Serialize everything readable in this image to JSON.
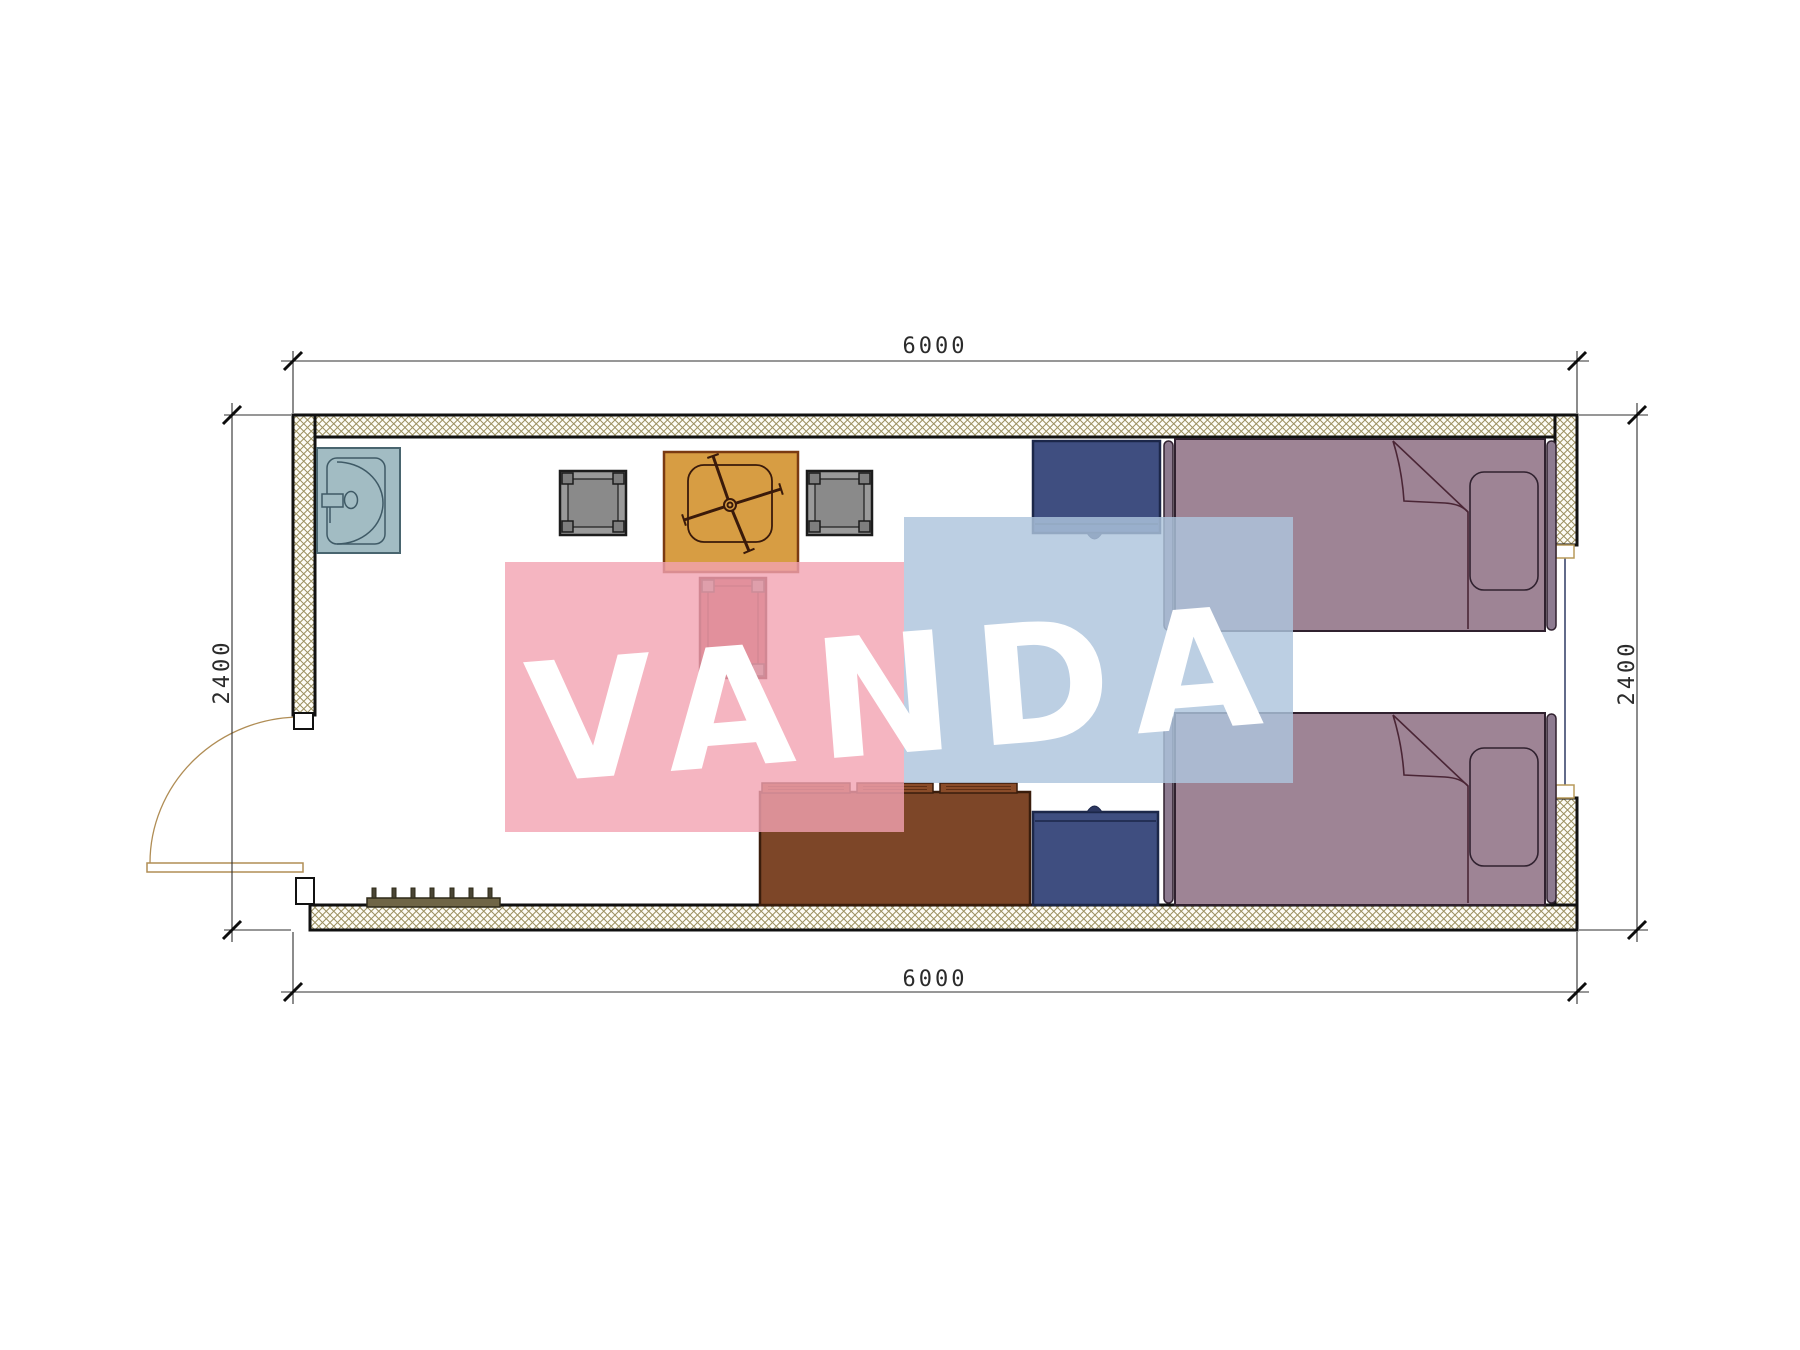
{
  "plan": {
    "type": "floor-plan",
    "room_width_mm": "6000",
    "room_depth_mm": "2400",
    "dimensions": {
      "top": "6000",
      "bottom": "6000",
      "left": "2400",
      "right": "2400"
    },
    "furniture": [
      "sink",
      "desk",
      "task-chair",
      "stool-left",
      "stool-right",
      "side-table",
      "sofa",
      "nightstand-top",
      "nightstand-bottom",
      "bed-top",
      "bed-bottom",
      "shoe-rack",
      "door",
      "window"
    ]
  },
  "watermark": {
    "text": "VANDA"
  },
  "colors": {
    "wall-line": "#111111",
    "hatch-line": "#9c9060",
    "hatch-bg": "#fdfcf6",
    "dim-line": "#2f2f2f",
    "dim-text": "#2b2b2b",
    "sill-line": "#b89a5a",
    "window-glass": "#2e3a63",
    "door-line": "#b08d55",
    "sink-fill": "#a2bcc3",
    "sink-line": "#49656f",
    "sink-inner": "#3f5a66",
    "desk-fill": "#d79d43",
    "desk-line": "#7a3a12",
    "chair-line": "#3a1a0a",
    "stool-fill": "#9a9a9a",
    "stool-fill2": "#8a8a8a",
    "stool-foot": "#7e7e7e",
    "stool-line": "#1c1c1c",
    "table-fill": "#a04848",
    "table-line": "#4a1c1c",
    "table-corner": "#909090",
    "nightstand-fill": "#3f4e80",
    "nightstand-line": "#1c2749",
    "knob": "#2c3761",
    "sofa-fill": "#7d4628",
    "sofa-line": "#3a1d0c",
    "cushion-fill": "#8a4c29",
    "cushion-seam": "#5f2f15",
    "bed-fill": "#9e8495",
    "bed-line": "#30212f",
    "board-fill": "#8d7b90",
    "fold-line": "#4a2535",
    "rack-fill": "#6f6546",
    "rack-line": "#2e2a18",
    "peg-fill": "#4a4534",
    "wm-pink": "rgba(242,163,178,0.80)",
    "wm-blue": "rgba(173,196,221,0.82)",
    "wm-text": "#ffffff"
  }
}
